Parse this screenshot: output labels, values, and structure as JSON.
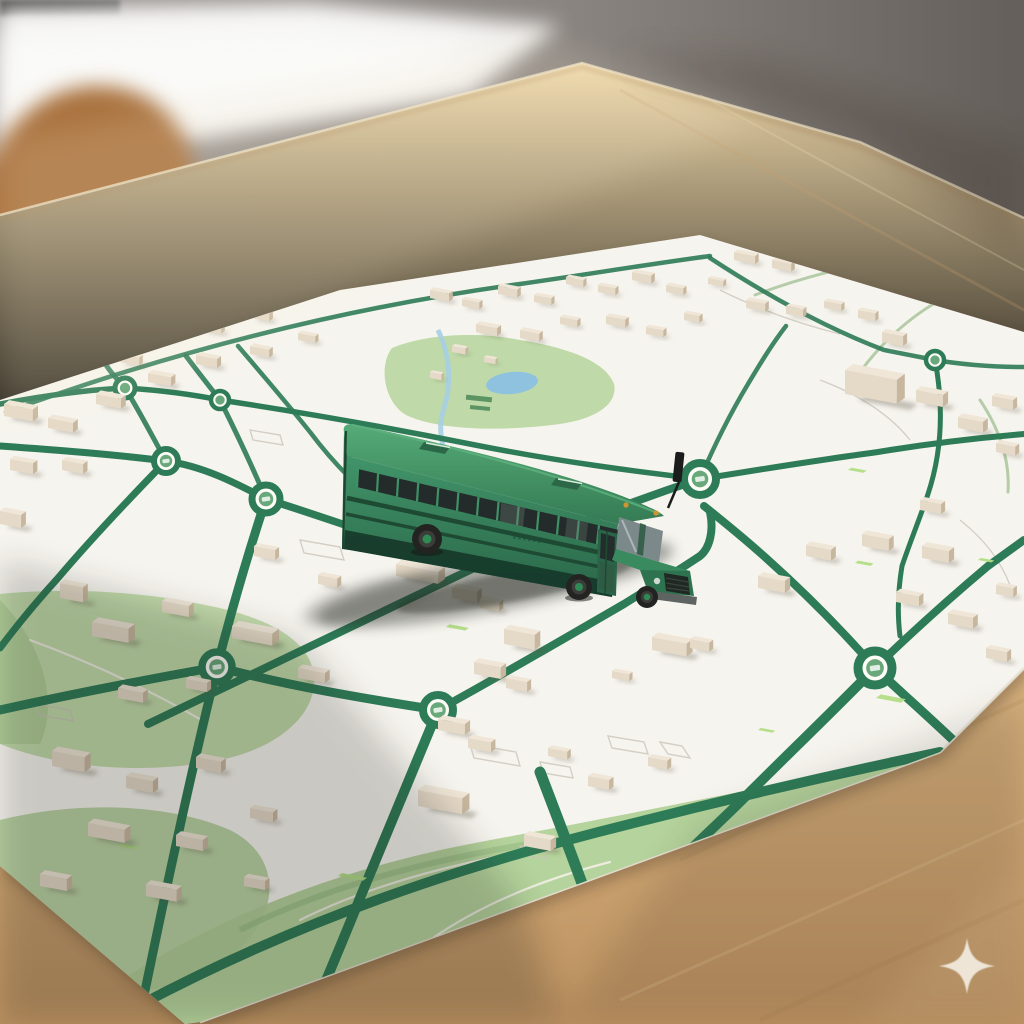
{
  "scene": {
    "caption": "A green toy school bus standing on a tactile 3D-printed city street map spread over a wooden table in a sunlit room",
    "objects": [
      {
        "name": "toy-bus",
        "label": "green school bus model"
      },
      {
        "name": "city-map",
        "label": "white city map sheet with green roads, roundabouts and parks"
      },
      {
        "name": "buildings",
        "label": "small beige 3D model buildings"
      },
      {
        "name": "table",
        "label": "light wooden table"
      },
      {
        "name": "chair",
        "label": "wooden chair back"
      },
      {
        "name": "window-light",
        "label": "bright window in background"
      },
      {
        "name": "sparkle-watermark",
        "label": "four-point sparkle mark"
      }
    ]
  },
  "colors": {
    "wall": "#8b8581",
    "wall-dark": "#6c6762",
    "window": "#f3f2f0",
    "chair-wood": "#a9713e",
    "table-light": "#efd7a8",
    "table-mid": "#dcb886",
    "table-dark": "#c09464",
    "paper": "#f6f4ee",
    "road-green": "#2e7b57",
    "road-green-light": "#a9c49b",
    "park-green": "#bcd8a3",
    "park-bright": "#b2dd85",
    "water-blue": "#8fc2de",
    "building-top": "#efe6d7",
    "building-front": "#e5d9c7",
    "building-side": "#c8b79f",
    "bus-roof": "#4aa26d",
    "bus-body": "#3f9166",
    "bus-dark": "#1e4a34",
    "bus-skirt": "#16382a",
    "window-glass": "#232c2a",
    "tire": "#232422",
    "hub-green": "#2f8a55",
    "amber-light": "#d2952c",
    "watermark": "#f0e9dd"
  }
}
